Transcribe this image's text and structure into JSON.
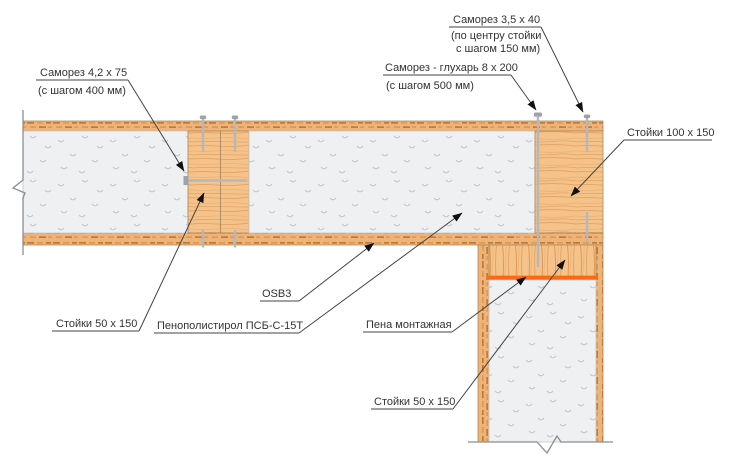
{
  "diagram": {
    "type": "construction-detail",
    "subject": "SIP panel wall corner joint section",
    "colors": {
      "wood_base": "#f2ba7d",
      "wood_dash_dark": "#c07a38",
      "wood_dash_mid": "#dd9a55",
      "wood_grain": "#e2a668",
      "foam_bg": "#eef0f2",
      "foam_mark": "#c3c9ce",
      "screw_gray": "#b4b8bc",
      "screw_head_gray": "#9ea3a8",
      "mounting_foam_orange": "#ff6912",
      "leader_line": "#444444",
      "text": "#333333"
    },
    "labels": {
      "screw_42x75": {
        "line1": "Саморез 4,2 х 75",
        "line2": "(с шагом 400 мм)"
      },
      "screw_35x40": {
        "line1": "Саморез 3,5 х 40",
        "line2": "(по центру стойки",
        "line3": "с шагом 150 мм)"
      },
      "lag_screw_8x200": {
        "line1": "Саморез - глухарь 8 х 200",
        "line2": "(с шагом 500 мм)"
      },
      "studs_100x150": {
        "line1": "Стойки 100 х 150"
      },
      "osb3": {
        "line1": "OSB3"
      },
      "polystyrene": {
        "line1": "Пенополистирол ПСБ-С-15Т"
      },
      "mounting_foam": {
        "line1": "Пена монтажная"
      },
      "studs_50x150_left": {
        "line1": "Стойки 50 х 150"
      },
      "studs_50x150_bottom": {
        "line1": "Стойки 50 х 150"
      }
    }
  }
}
